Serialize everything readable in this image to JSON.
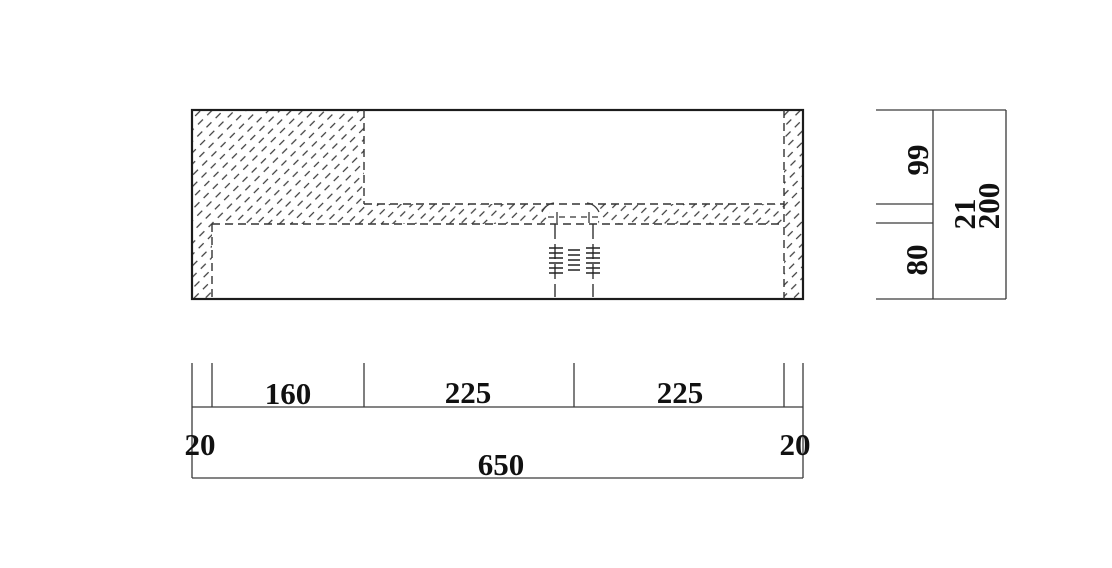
{
  "canvas": {
    "background": "#ffffff",
    "line_color": "#2b2b2b",
    "text_color": "#111111"
  },
  "bottom_dims": {
    "offset_left": "20",
    "seg_1": "160",
    "seg_2": "225",
    "seg_3": "225",
    "offset_right": "20",
    "total": "650"
  },
  "right_dims": {
    "upper": "99",
    "slab": "21",
    "lower": "80",
    "total": "200"
  }
}
